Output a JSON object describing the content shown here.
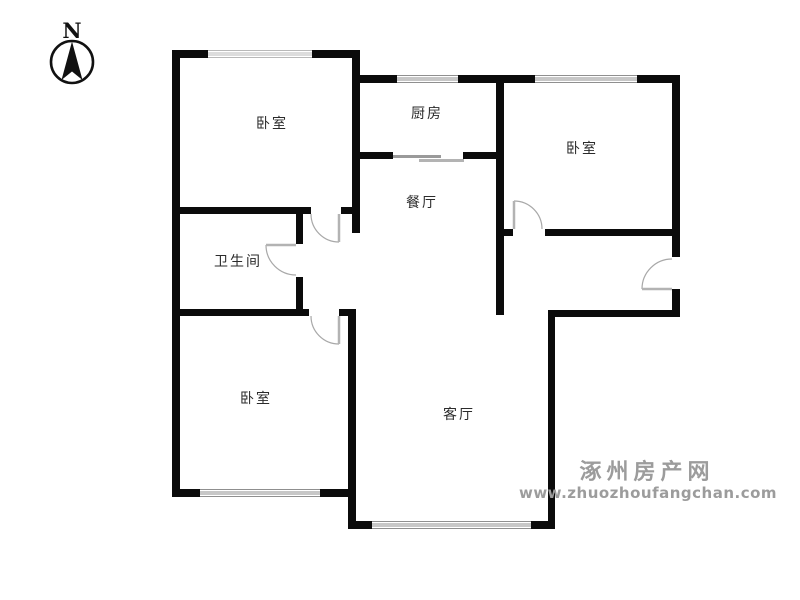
{
  "compass": {
    "label": "N"
  },
  "rooms": {
    "bedroom_top_left": "卧室",
    "kitchen": "厨房",
    "bedroom_top_right": "卧室",
    "dining": "餐厅",
    "bathroom": "卫生间",
    "bedroom_bottom_left": "卧室",
    "living": "客厅"
  },
  "watermark": {
    "site_name": "涿州房产网",
    "url": "www.zhuozhoufangchan.com"
  },
  "colors": {
    "wall": "#0b0b0b",
    "window_line": "#8f8f8f",
    "door_line": "#a8a8a8",
    "watermark": "#9c9c9c",
    "label_text": "#2b2b2b"
  }
}
